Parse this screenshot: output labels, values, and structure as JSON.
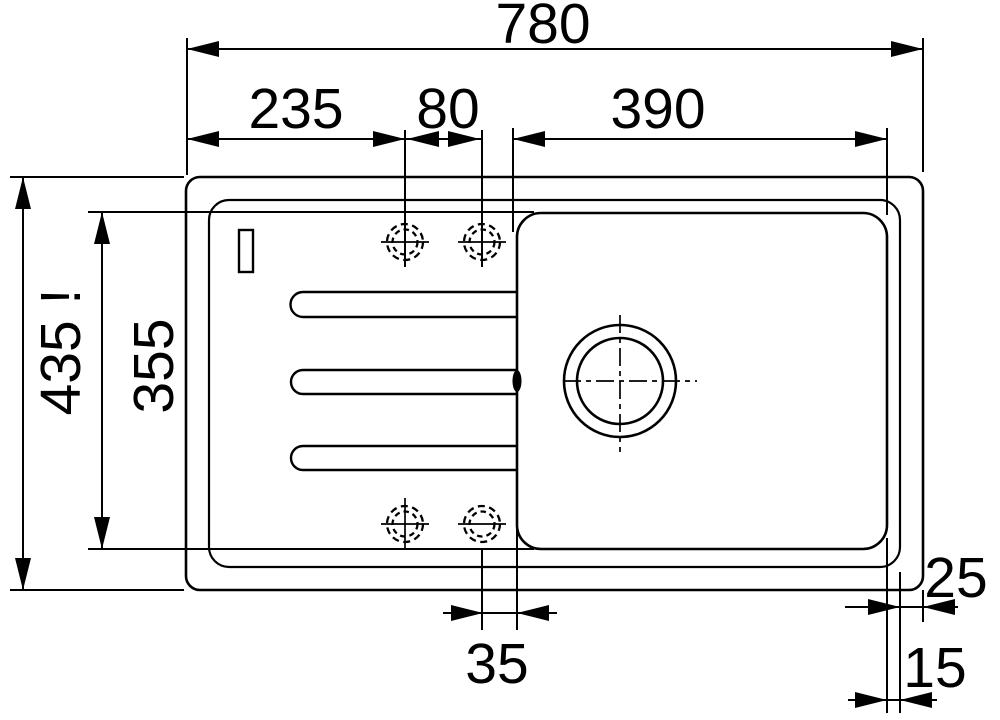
{
  "drawing": {
    "type": "technical-dimension-drawing",
    "subject": "inset kitchen sink with drainboard, top view",
    "colors": {
      "line": "#000000",
      "accent_red": "#e8261c",
      "background": "#ffffff"
    },
    "dims": {
      "overall_width": "780",
      "left_section_width": "235",
      "tap_hole_spacing": "80",
      "bowl_width": "390",
      "overall_depth": "435 !",
      "bowl_depth": "355",
      "hole_to_bowl_offset": "35",
      "rim_to_edge_offset": "25",
      "bowl_to_rim_offset": "15"
    }
  }
}
